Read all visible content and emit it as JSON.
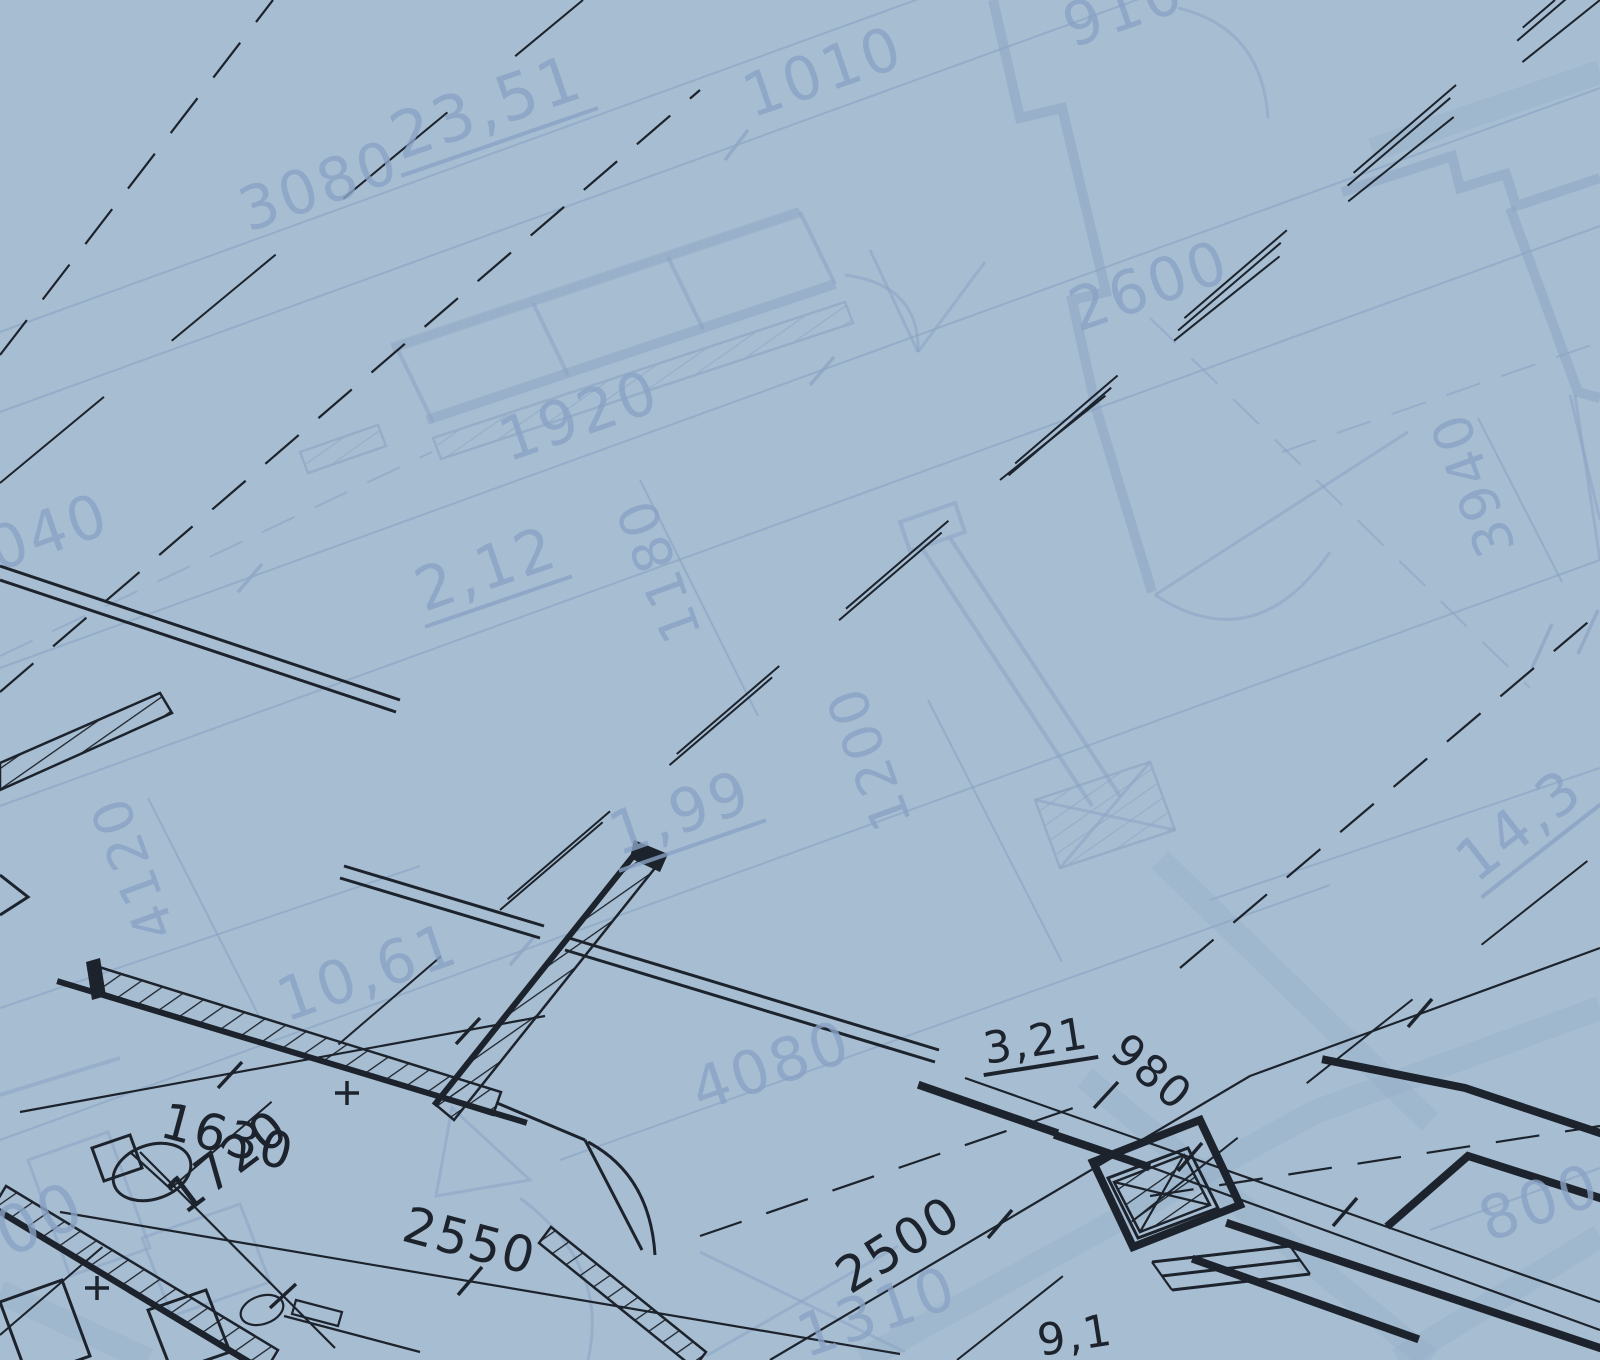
{
  "scene": {
    "type": "architectural-blueprint-floor-plan",
    "width": 1600,
    "height": 1360,
    "layers": [
      "faint-underlay-plan",
      "dark-foreground-plan"
    ]
  },
  "colors": {
    "background": "#a7bdd2",
    "faint_line": "#8ba4c3",
    "faint_text": "#8aa3c5",
    "dark_line": "#1c232c",
    "wide_band": "#93abc8"
  },
  "labels": [
    {
      "text": "3080",
      "x": 248,
      "y": 232,
      "rot": -19,
      "size": 60,
      "layer": "faint",
      "underline": false
    },
    {
      "text": "23,51",
      "x": 400,
      "y": 160,
      "rot": -19,
      "size": 64,
      "layer": "faint",
      "underline": true
    },
    {
      "text": "1010",
      "x": 752,
      "y": 118,
      "rot": -19,
      "size": 60,
      "layer": "faint",
      "underline": false
    },
    {
      "text": "910",
      "x": 1072,
      "y": 48,
      "rot": -19,
      "size": 60,
      "layer": "faint",
      "underline": false
    },
    {
      "text": "2600",
      "x": 1078,
      "y": 332,
      "rot": -19,
      "size": 60,
      "layer": "faint",
      "underline": false
    },
    {
      "text": "1920",
      "x": 508,
      "y": 462,
      "rot": -19,
      "size": 60,
      "layer": "faint",
      "underline": false
    },
    {
      "text": "2,12",
      "x": 424,
      "y": 612,
      "rot": -19,
      "size": 60,
      "layer": "faint",
      "underline": true
    },
    {
      "text": "1040",
      "x": -42,
      "y": 585,
      "rot": -19,
      "size": 60,
      "layer": "faint",
      "underline": false
    },
    {
      "text": "1,99",
      "x": 618,
      "y": 856,
      "rot": -19,
      "size": 60,
      "layer": "faint",
      "underline": true
    },
    {
      "text": "10,61",
      "x": 286,
      "y": 1022,
      "rot": -19,
      "size": 60,
      "layer": "faint",
      "underline": false
    },
    {
      "text": "4080",
      "x": 700,
      "y": 1112,
      "rot": -19,
      "size": 60,
      "layer": "faint",
      "underline": false
    },
    {
      "text": "1310",
      "x": 806,
      "y": 1358,
      "rot": -19,
      "size": 60,
      "layer": "faint",
      "underline": false
    },
    {
      "text": "800",
      "x": 1488,
      "y": 1242,
      "rot": -19,
      "size": 60,
      "layer": "faint",
      "underline": false
    },
    {
      "text": "00",
      "x": 8,
      "y": 1258,
      "rot": -24,
      "size": 66,
      "layer": "faint",
      "underline": false
    },
    {
      "text": "14,3",
      "x": 1476,
      "y": 884,
      "rot": -38,
      "size": 58,
      "layer": "faint",
      "underline": true
    },
    {
      "text": "1180",
      "x": 702,
      "y": 634,
      "rot": -110,
      "size": 54,
      "layer": "faint",
      "underline": false
    },
    {
      "text": "1200",
      "x": 912,
      "y": 822,
      "rot": -110,
      "size": 54,
      "layer": "faint",
      "underline": false
    },
    {
      "text": "3940",
      "x": 1516,
      "y": 548,
      "rot": -110,
      "size": 54,
      "layer": "faint",
      "underline": false
    },
    {
      "text": "4120",
      "x": 176,
      "y": 932,
      "rot": -110,
      "size": 54,
      "layer": "faint",
      "underline": false
    },
    {
      "text": "1630",
      "x": 158,
      "y": 1136,
      "rot": 15,
      "size": 50,
      "layer": "dark",
      "underline": false
    },
    {
      "text": "1720",
      "x": 184,
      "y": 1216,
      "rot": -37,
      "size": 50,
      "layer": "dark",
      "underline": false
    },
    {
      "text": "2550",
      "x": 400,
      "y": 1240,
      "rot": 15,
      "size": 50,
      "layer": "dark",
      "underline": false
    },
    {
      "text": "2500",
      "x": 850,
      "y": 1295,
      "rot": -32,
      "size": 50,
      "layer": "dark",
      "underline": false
    },
    {
      "text": "3,21",
      "x": 986,
      "y": 1064,
      "rot": -9,
      "size": 44,
      "layer": "dark",
      "underline": true
    },
    {
      "text": "980",
      "x": 1108,
      "y": 1054,
      "rot": 41,
      "size": 44,
      "layer": "dark",
      "underline": false
    },
    {
      "text": "9,1",
      "x": 1040,
      "y": 1356,
      "rot": -9,
      "size": 44,
      "layer": "dark",
      "underline": false
    }
  ]
}
